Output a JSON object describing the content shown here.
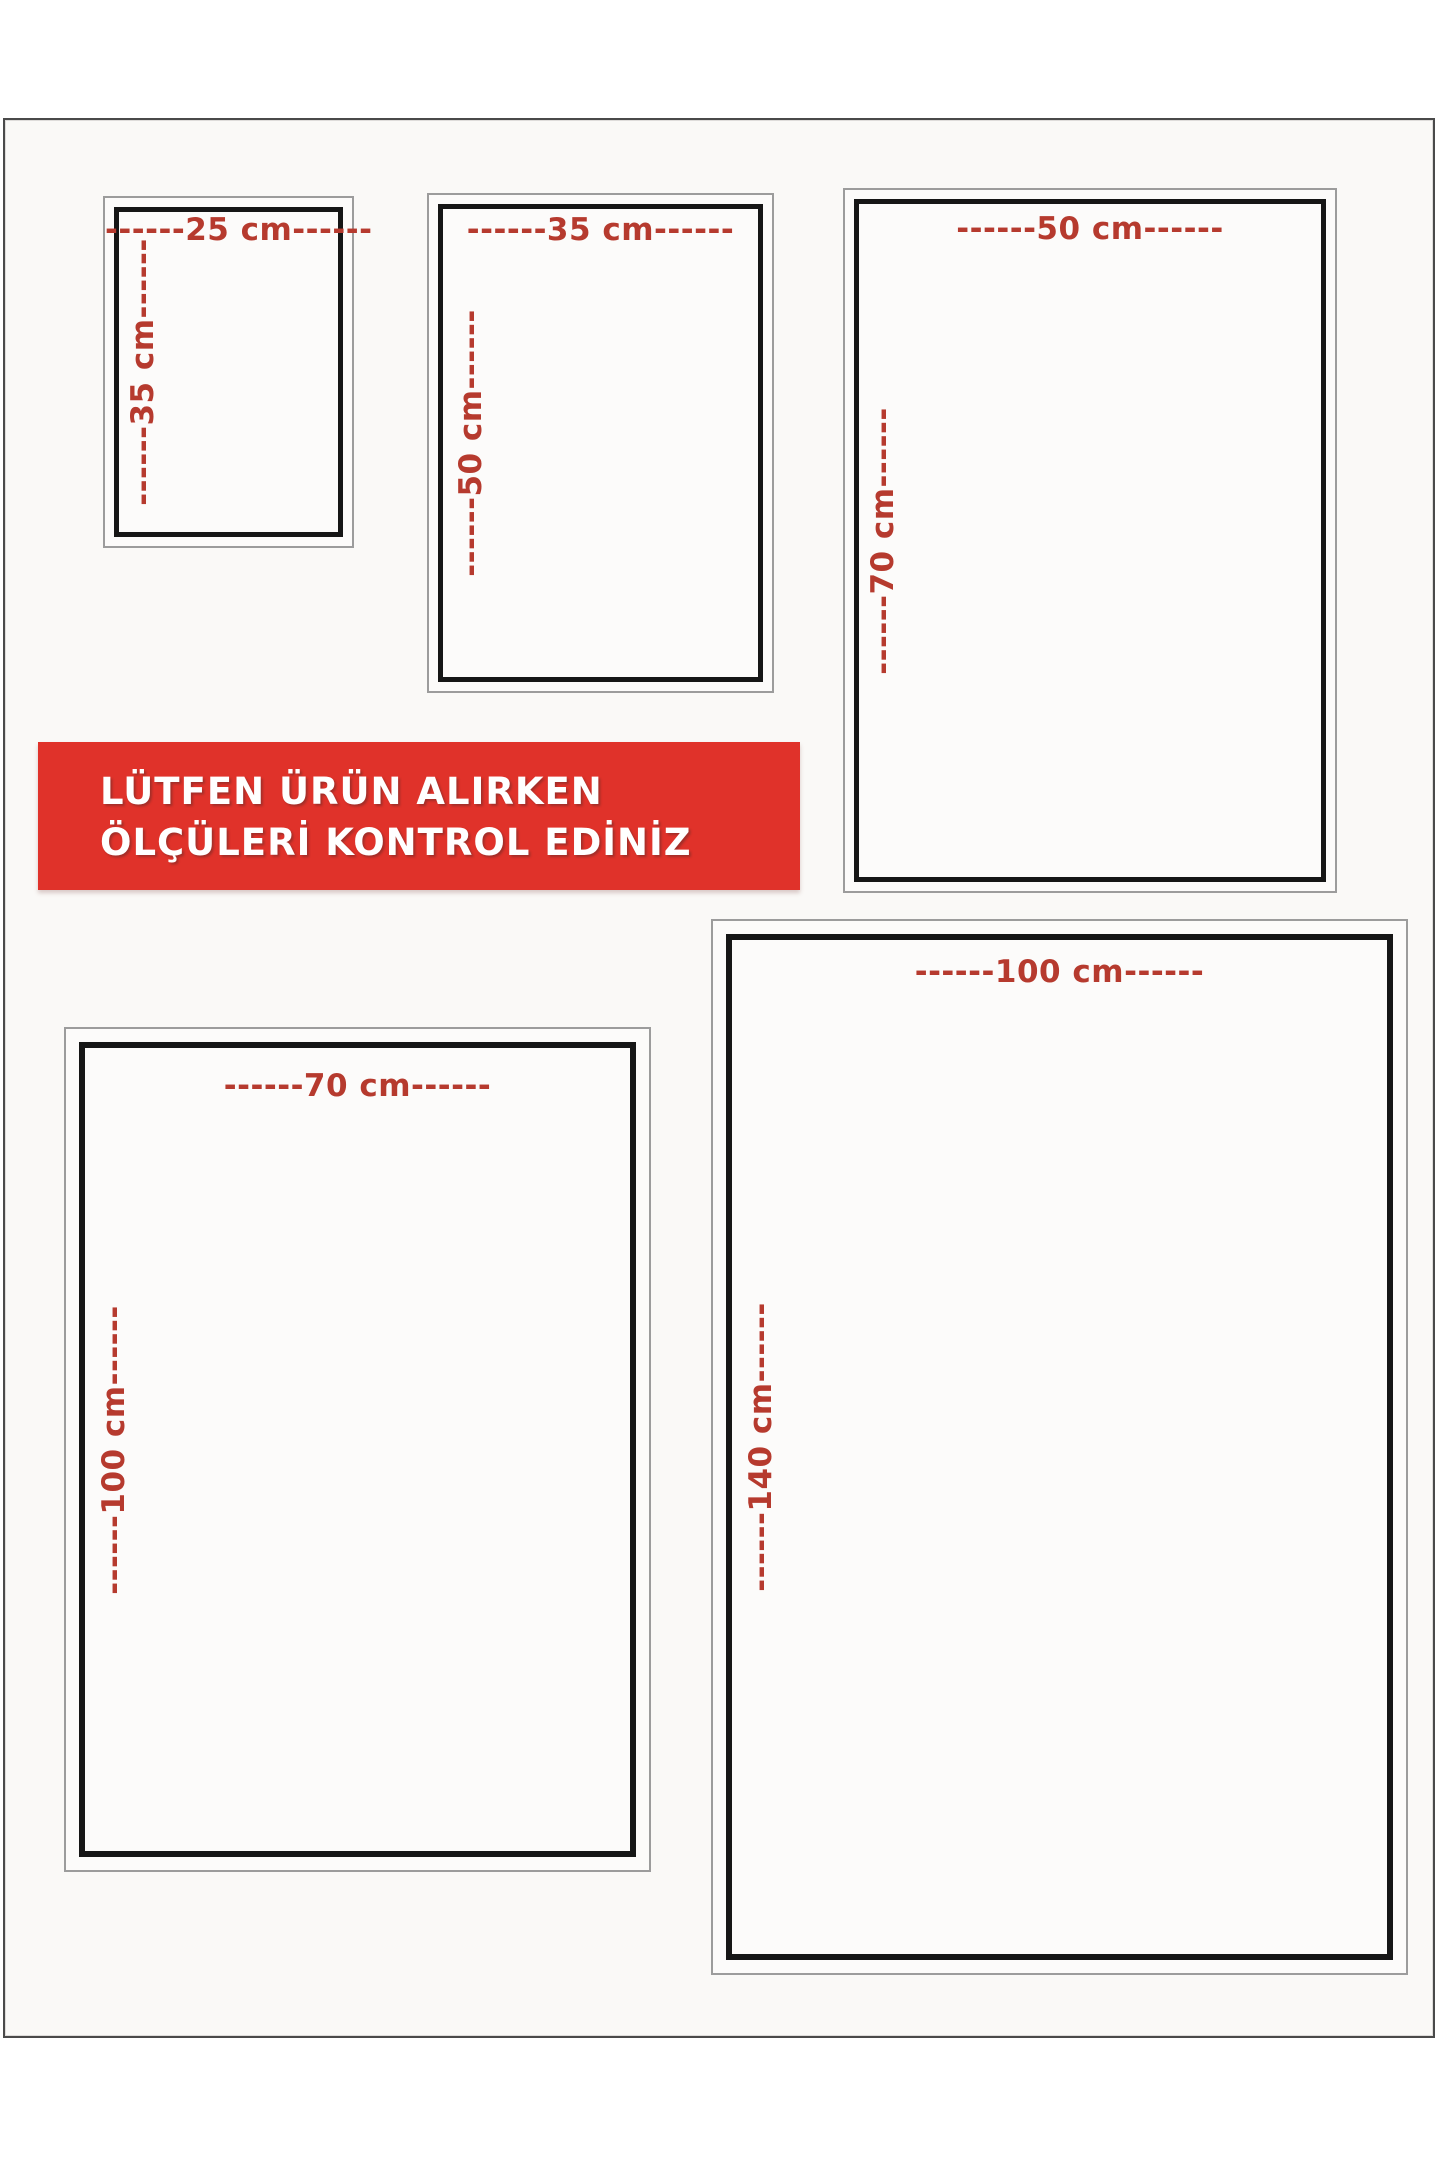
{
  "banner": {
    "line1": "LÜTFEN ÜRÜN ALIRKEN",
    "line2": "ÖLÇÜLERİ KONTROL EDİNİZ"
  },
  "sizes": [
    {
      "width_cm": 25,
      "height_cm": 35,
      "width_label": "------25 cm------",
      "height_label": "------35 cm------"
    },
    {
      "width_cm": 35,
      "height_cm": 50,
      "width_label": "------35 cm------",
      "height_label": "------50 cm------"
    },
    {
      "width_cm": 50,
      "height_cm": 70,
      "width_label": "------50 cm------",
      "height_label": "------70 cm------"
    },
    {
      "width_cm": 70,
      "height_cm": 100,
      "width_label": "------70 cm------",
      "height_label": "------100 cm------"
    },
    {
      "width_cm": 100,
      "height_cm": 140,
      "width_label": "------100 cm------",
      "height_label": "------140 cm------"
    }
  ],
  "colors": {
    "label_red": "#b63a2e",
    "banner_red": "#e0322a",
    "inner_border": "#161616",
    "outer_border": "#9c9c9c",
    "page_border": "#4a4a4a",
    "page_bg": "#faf9f7"
  }
}
